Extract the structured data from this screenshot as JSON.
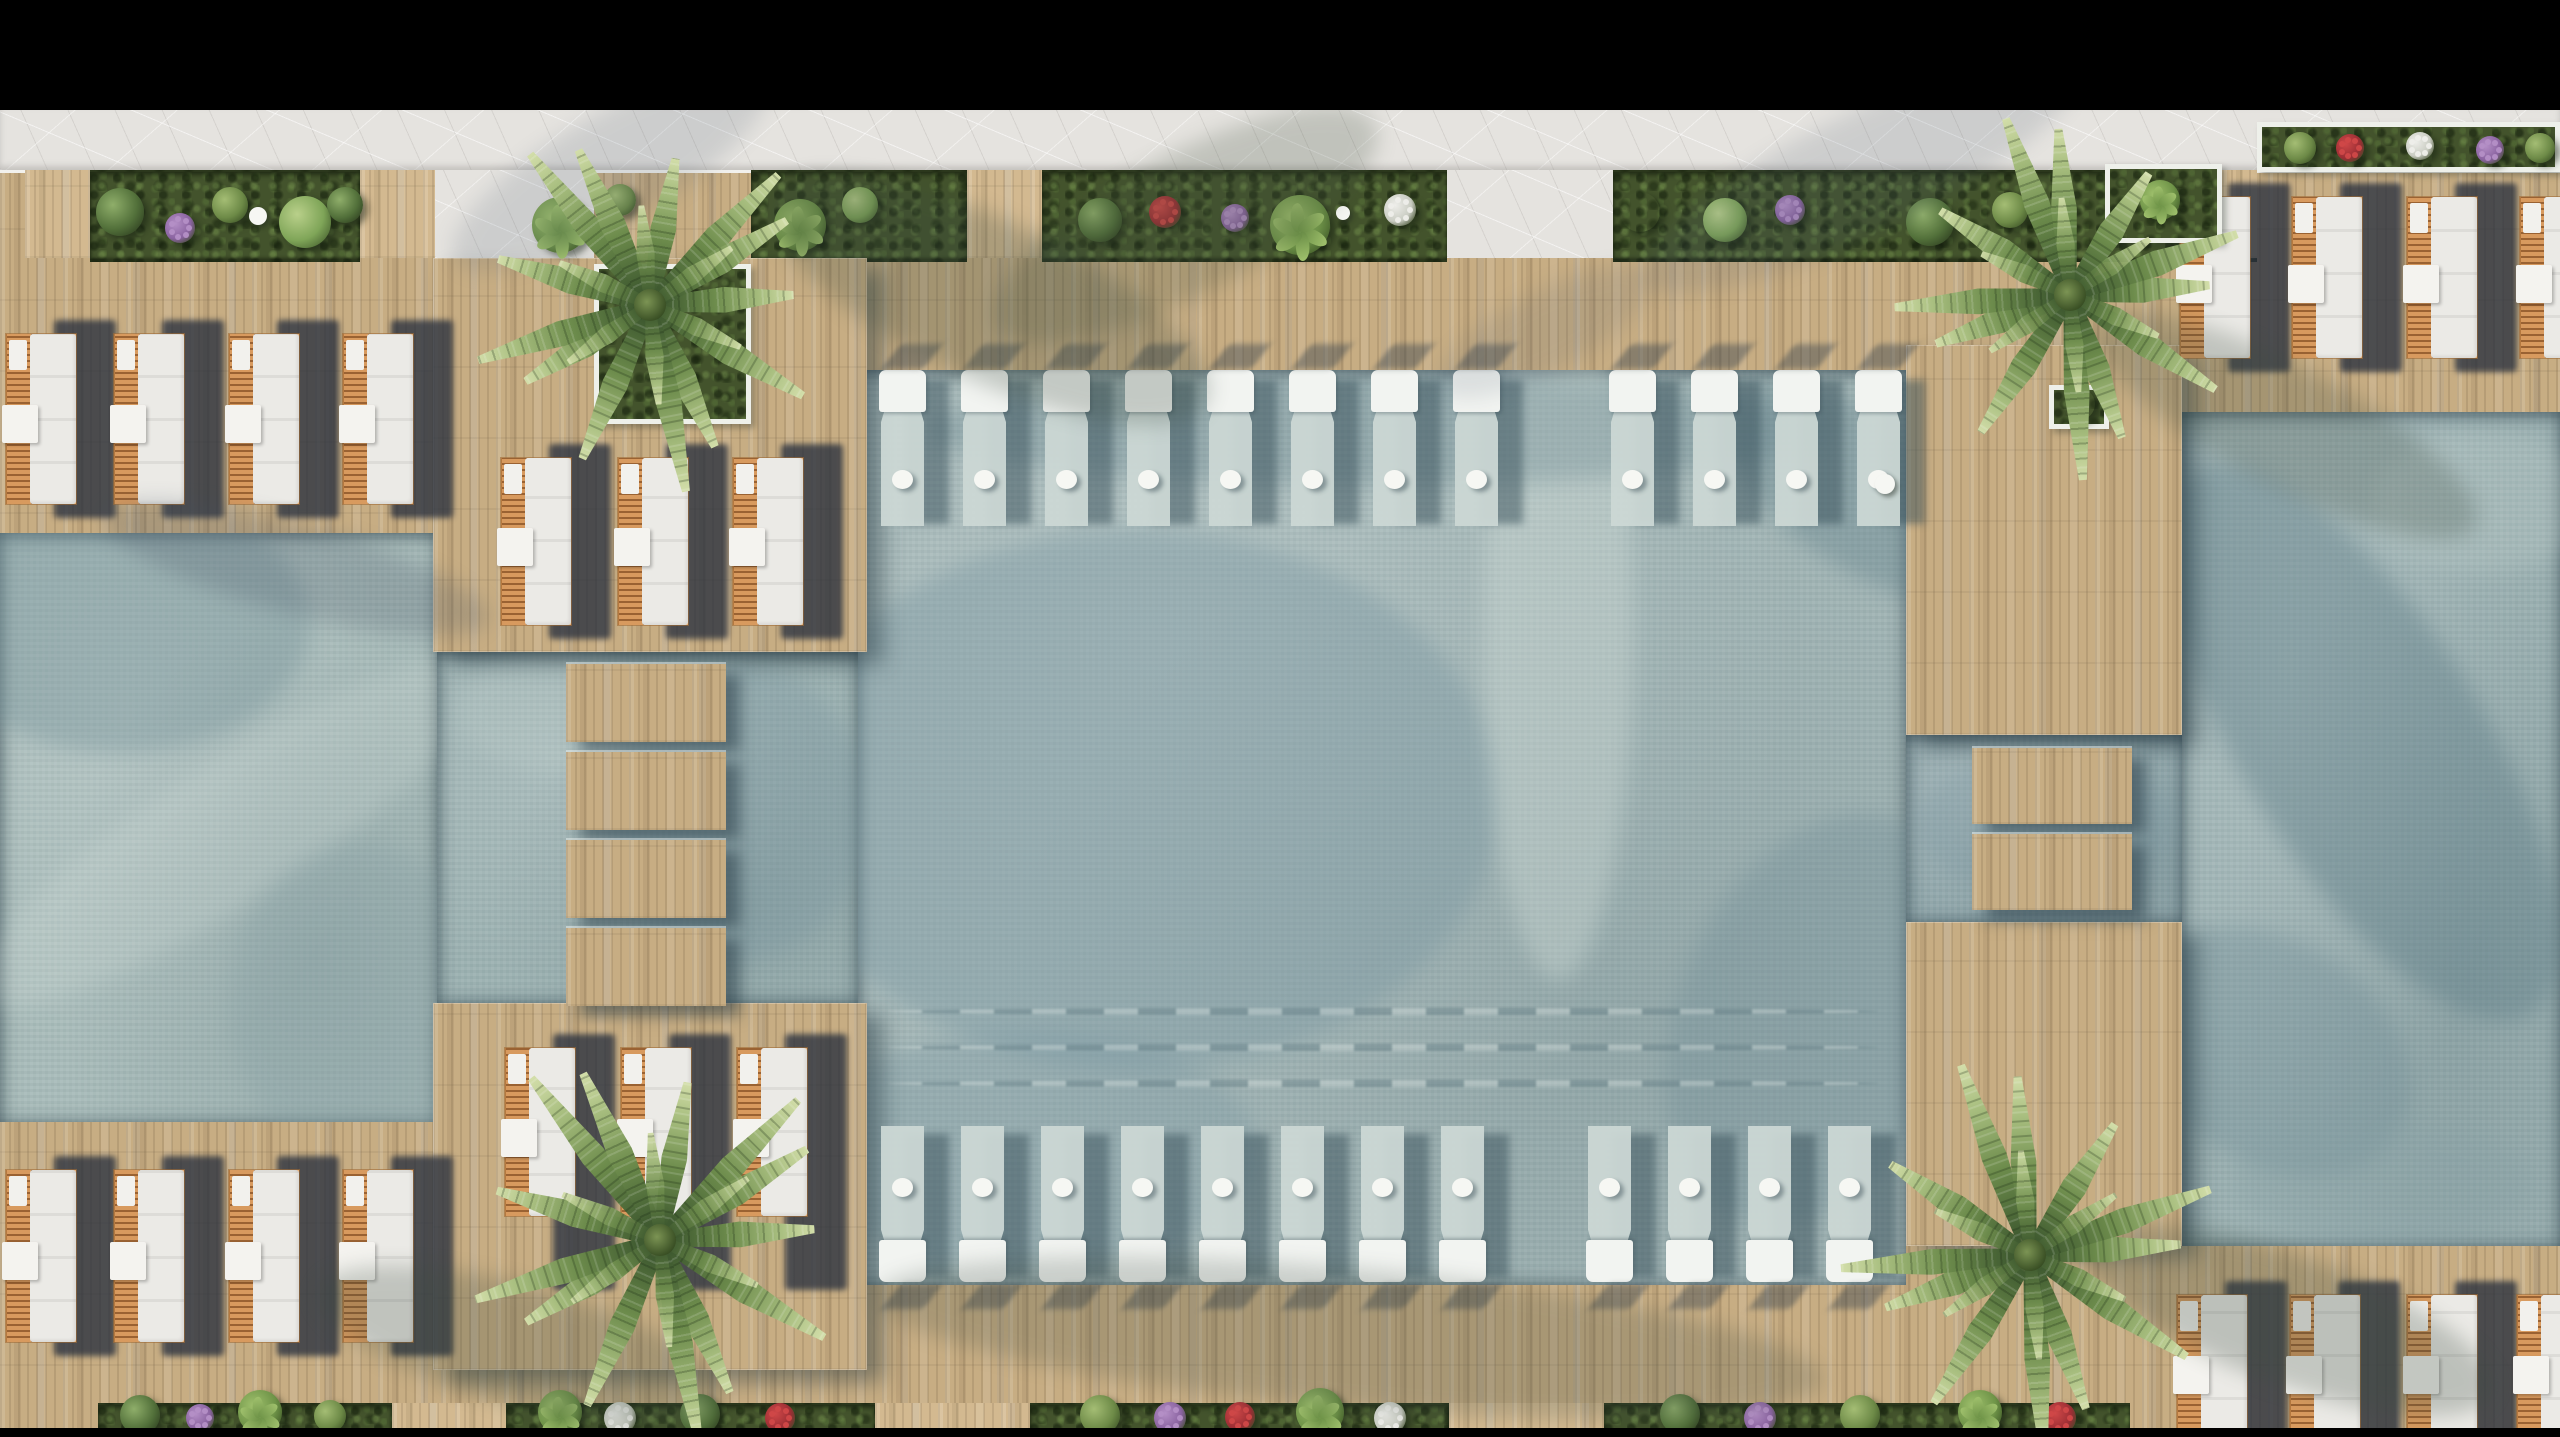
{
  "meta": {
    "description": "Aerial top-down 3D architectural rendering of a resort pool deck: three connected pools with stepping stones, wooden deck, sun loungers, in-pool loungers and palm trees",
    "width": 2560,
    "height": 1437
  },
  "palette": {
    "black": "#000000",
    "pavement": "#e5e3df",
    "deck": "#c7ad83",
    "deck_path": "#d3bd96",
    "garden": "#43532c",
    "garden_dark": "#2c3a1e",
    "water_left": "#a9bcba",
    "water_left_channel": "#9db2b2",
    "water_central": "#a3b6b6",
    "water_right_channel": "#92a8ac",
    "water_right": "#9cb1b2",
    "lounger_cushion": "#ebeae6",
    "lounger_wood": "#cf8f52",
    "pool_lounger_head": "#f2f4f1",
    "pool_lounger_body": "#ccd8d4",
    "shadow_furniture": "rgba(40,48,62,0.78)",
    "white_dot": "#f6f7f3",
    "planter_wall": "#eef0ea"
  },
  "bars": {
    "top": {
      "x": 0,
      "y": 0,
      "w": 2560,
      "h": 110
    },
    "bottom": {
      "x": 0,
      "y": 1428,
      "w": 2560,
      "h": 9
    }
  },
  "pavement_band": {
    "x": 0,
    "y": 110,
    "w": 2560,
    "h": 60
  },
  "garden_strips": {
    "top": {
      "y": 170,
      "h": 88,
      "segments": [
        {
          "type": "deck",
          "x": 25,
          "w": 65
        },
        {
          "type": "garden",
          "x": 90,
          "w": 270
        },
        {
          "type": "path",
          "x": 360,
          "w": 75
        },
        {
          "type": "pave",
          "x": 435,
          "w": 159
        },
        {
          "type": "garden",
          "x": 751,
          "w": 216
        },
        {
          "type": "path",
          "x": 967,
          "w": 75
        },
        {
          "type": "garden",
          "x": 1042,
          "w": 405
        },
        {
          "type": "pave",
          "x": 1447,
          "w": 166
        },
        {
          "type": "garden",
          "x": 1613,
          "w": 644
        },
        {
          "type": "deck",
          "x": 2222,
          "w": 35
        }
      ]
    },
    "bottom": {
      "y": 1403,
      "h": 34,
      "segments": [
        {
          "type": "garden",
          "x": 98,
          "w": 294
        },
        {
          "type": "path",
          "x": 392,
          "w": 114
        },
        {
          "type": "garden",
          "x": 506,
          "w": 369
        },
        {
          "type": "path",
          "x": 875,
          "w": 155
        },
        {
          "type": "garden",
          "x": 1030,
          "w": 419
        },
        {
          "type": "path",
          "x": 1449,
          "w": 155
        },
        {
          "type": "garden",
          "x": 1604,
          "w": 526
        }
      ]
    }
  },
  "pools": [
    {
      "name": "left-pool",
      "x": 0,
      "y": 533,
      "w": 437,
      "h": 589,
      "base": "water_left",
      "patches": [
        {
          "cx": 120,
          "cy": 90,
          "w": 380,
          "h": 260,
          "rot": 0,
          "c": "#6e8c94",
          "a": 0.35
        },
        {
          "cx": 230,
          "cy": 300,
          "w": 600,
          "h": 140,
          "rot": -33,
          "c": "#e8efe9",
          "a": 0.16
        },
        {
          "cx": 360,
          "cy": 470,
          "w": 260,
          "h": 320,
          "rot": 0,
          "c": "#87a0a4",
          "a": 0.28
        }
      ]
    },
    {
      "name": "left-channel",
      "x": 437,
      "y": 652,
      "w": 421,
      "h": 351,
      "base": "water_left_channel",
      "patches": [
        {
          "cx": 300,
          "cy": 160,
          "w": 260,
          "h": 300,
          "rot": 0,
          "c": "#7b96a0",
          "a": 0.35
        },
        {
          "cx": 120,
          "cy": 60,
          "w": 200,
          "h": 120,
          "rot": 0,
          "c": "#c6d4d0",
          "a": 0.2
        }
      ]
    },
    {
      "name": "central-pool",
      "x": 858,
      "y": 370,
      "w": 1048,
      "h": 915,
      "base": "water_central",
      "patches": [
        {
          "cx": 280,
          "cy": 430,
          "w": 720,
          "h": 540,
          "rot": 0,
          "c": "#7a97a1",
          "a": 0.4
        },
        {
          "cx": 700,
          "cy": 260,
          "w": 150,
          "h": 700,
          "rot": 0,
          "c": "#dce6df",
          "a": 0.3
        },
        {
          "cx": 1000,
          "cy": 120,
          "w": 320,
          "h": 150,
          "rot": 35,
          "c": "#5e7d87",
          "a": 0.35
        },
        {
          "cx": 170,
          "cy": 780,
          "w": 460,
          "h": 240,
          "rot": 0,
          "c": "#7a97a1",
          "a": 0.33
        },
        {
          "cx": 960,
          "cy": 650,
          "w": 280,
          "h": 430,
          "rot": 22,
          "c": "#6d8a94",
          "a": 0.3
        },
        {
          "cx": 520,
          "cy": 60,
          "w": 900,
          "h": 110,
          "rot": 0,
          "c": "#5e7d87",
          "a": 0.28
        }
      ]
    },
    {
      "name": "right-channel",
      "x": 1906,
      "y": 735,
      "w": 276,
      "h": 187,
      "base": "water_right_channel",
      "patches": [
        {
          "cx": 140,
          "cy": 90,
          "w": 260,
          "h": 140,
          "rot": 0,
          "c": "#7b96a0",
          "a": 0.3
        }
      ]
    },
    {
      "name": "right-pool",
      "x": 2182,
      "y": 412,
      "w": 378,
      "h": 834,
      "base": "water_right",
      "patches": [
        {
          "cx": 180,
          "cy": 330,
          "w": 640,
          "h": 240,
          "rot": 58,
          "c": "#5d7c86",
          "a": 0.4
        },
        {
          "cx": 300,
          "cy": 90,
          "w": 220,
          "h": 140,
          "rot": 0,
          "c": "#c6d4d0",
          "a": 0.22
        },
        {
          "cx": 90,
          "cy": 640,
          "w": 300,
          "h": 220,
          "rot": 35,
          "c": "#6d8a94",
          "a": 0.33
        },
        {
          "cx": 200,
          "cy": 770,
          "w": 300,
          "h": 120,
          "rot": 0,
          "c": "#87a0a4",
          "a": 0.3
        }
      ]
    }
  ],
  "ripples": {
    "pool": "central-pool",
    "x": 30,
    "w": 990,
    "ys": [
      638,
      674,
      710
    ]
  },
  "platforms": [
    {
      "name": "top-platform",
      "x": 433,
      "y": 258,
      "w": 434,
      "h": 394
    },
    {
      "name": "bottom-platform",
      "x": 433,
      "y": 1003,
      "w": 434,
      "h": 367
    },
    {
      "name": "upper-pier",
      "x": 1906,
      "y": 345,
      "w": 276,
      "h": 390
    },
    {
      "name": "lower-pier",
      "x": 1906,
      "y": 922,
      "w": 276,
      "h": 324
    }
  ],
  "stepping_stones": {
    "left": {
      "x": 566,
      "w": 160,
      "h": 78,
      "ys": [
        664,
        752,
        840,
        928
      ]
    },
    "right": {
      "x": 1972,
      "w": 160,
      "h": 76,
      "ys": [
        748,
        834
      ]
    }
  },
  "pool_lounger_rows": [
    {
      "name": "top-row",
      "y": 370,
      "h": 158,
      "dot_y": 470,
      "flip": false,
      "groups": [
        {
          "x0": 879,
          "n": 8,
          "pitch": 82
        },
        {
          "x0": 1609,
          "n": 4,
          "pitch": 82
        }
      ]
    },
    {
      "name": "bottom-row",
      "y": 1124,
      "h": 158,
      "dot_y": 1178,
      "flip": true,
      "groups": [
        {
          "x0": 879,
          "n": 8,
          "pitch": 80
        },
        {
          "x0": 1586,
          "n": 4,
          "pitch": 80
        }
      ]
    }
  ],
  "deck_lounger_groups": [
    {
      "name": "top-left",
      "y": 334,
      "h": 170,
      "xs": [
        6,
        114,
        229,
        343
      ]
    },
    {
      "name": "top-middle",
      "y": 458,
      "h": 167,
      "xs": [
        501,
        618,
        733
      ]
    },
    {
      "name": "top-right",
      "y": 197,
      "h": 161,
      "xs": [
        2180,
        2292,
        2407,
        2520
      ]
    },
    {
      "name": "bottom-left",
      "y": 1170,
      "h": 172,
      "xs": [
        6,
        114,
        229,
        343
      ]
    },
    {
      "name": "bottom-middle",
      "y": 1048,
      "h": 168,
      "xs": [
        505,
        621,
        737
      ],
      "shadow_extend": 60
    },
    {
      "name": "bottom-right",
      "y": 1295,
      "h": 145,
      "xs": [
        2177,
        2290,
        2407,
        2517
      ]
    }
  ],
  "planters": [
    {
      "name": "palm-planter-top-left",
      "x": 594,
      "y": 264,
      "w": 157,
      "h": 160
    },
    {
      "name": "palm-planter-top-right",
      "x": 2105,
      "y": 164,
      "w": 117,
      "h": 79
    },
    {
      "name": "flower-planter-top-right",
      "x": 2257,
      "y": 122,
      "w": 303,
      "h": 50
    },
    {
      "name": "agave-planter",
      "x": 2049,
      "y": 385,
      "w": 60,
      "h": 44
    }
  ],
  "palms": [
    {
      "name": "palm-top-left",
      "cx": 650,
      "cy": 305,
      "r": 200,
      "fronds": 13
    },
    {
      "name": "palm-top-right",
      "cx": 2070,
      "cy": 295,
      "r": 195,
      "fronds": 12
    },
    {
      "name": "palm-bottom-left",
      "cx": 660,
      "cy": 1240,
      "r": 215,
      "fronds": 13
    },
    {
      "name": "palm-bottom-right",
      "cx": 2030,
      "cy": 1255,
      "r": 210,
      "fronds": 12
    }
  ],
  "plants_top": [
    {
      "x": 120,
      "y": 212,
      "r": 24,
      "type": "shrub"
    },
    {
      "x": 180,
      "y": 228,
      "r": 15,
      "type": "flowers-purple"
    },
    {
      "x": 230,
      "y": 205,
      "r": 18,
      "type": "grass"
    },
    {
      "x": 305,
      "y": 222,
      "r": 26,
      "type": "shrub-light"
    },
    {
      "x": 345,
      "y": 205,
      "r": 18,
      "type": "shrub"
    },
    {
      "x": 560,
      "y": 225,
      "r": 28,
      "type": "banana"
    },
    {
      "x": 620,
      "y": 200,
      "r": 16,
      "type": "grass"
    },
    {
      "x": 800,
      "y": 225,
      "r": 26,
      "type": "banana"
    },
    {
      "x": 860,
      "y": 205,
      "r": 18,
      "type": "shrub-light"
    },
    {
      "x": 1100,
      "y": 220,
      "r": 22,
      "type": "shrub"
    },
    {
      "x": 1165,
      "y": 212,
      "r": 16,
      "type": "flowers-red"
    },
    {
      "x": 1235,
      "y": 218,
      "r": 14,
      "type": "flowers-purple"
    },
    {
      "x": 1300,
      "y": 225,
      "r": 30,
      "type": "banana"
    },
    {
      "x": 1400,
      "y": 210,
      "r": 16,
      "type": "flowers-white"
    },
    {
      "x": 1640,
      "y": 212,
      "r": 20,
      "type": "agave"
    },
    {
      "x": 1725,
      "y": 220,
      "r": 22,
      "type": "shrub-light"
    },
    {
      "x": 1790,
      "y": 210,
      "r": 15,
      "type": "flowers-purple"
    },
    {
      "x": 1930,
      "y": 222,
      "r": 24,
      "type": "shrub"
    },
    {
      "x": 2010,
      "y": 210,
      "r": 18,
      "type": "grass"
    },
    {
      "x": 2160,
      "y": 200,
      "r": 20,
      "type": "banana"
    },
    {
      "x": 2300,
      "y": 148,
      "r": 16,
      "type": "grass"
    },
    {
      "x": 2350,
      "y": 148,
      "r": 14,
      "type": "flowers-red"
    },
    {
      "x": 2420,
      "y": 146,
      "r": 14,
      "type": "flowers-white"
    },
    {
      "x": 2490,
      "y": 150,
      "r": 14,
      "type": "flowers-purple"
    },
    {
      "x": 2540,
      "y": 148,
      "r": 15,
      "type": "grass"
    },
    {
      "x": 2079,
      "y": 404,
      "r": 16,
      "type": "agave"
    }
  ],
  "plants_bottom": [
    {
      "x": 140,
      "y": 1415,
      "r": 20,
      "type": "shrub"
    },
    {
      "x": 200,
      "y": 1418,
      "r": 14,
      "type": "flowers-purple"
    },
    {
      "x": 260,
      "y": 1412,
      "r": 22,
      "type": "banana"
    },
    {
      "x": 330,
      "y": 1416,
      "r": 16,
      "type": "grass"
    },
    {
      "x": 560,
      "y": 1412,
      "r": 22,
      "type": "banana"
    },
    {
      "x": 620,
      "y": 1418,
      "r": 16,
      "type": "flowers-white"
    },
    {
      "x": 700,
      "y": 1414,
      "r": 20,
      "type": "shrub"
    },
    {
      "x": 780,
      "y": 1418,
      "r": 15,
      "type": "flowers-red"
    },
    {
      "x": 1100,
      "y": 1415,
      "r": 20,
      "type": "grass"
    },
    {
      "x": 1170,
      "y": 1418,
      "r": 16,
      "type": "flowers-purple"
    },
    {
      "x": 1240,
      "y": 1417,
      "r": 15,
      "type": "flowers-red"
    },
    {
      "x": 1320,
      "y": 1412,
      "r": 24,
      "type": "banana"
    },
    {
      "x": 1390,
      "y": 1418,
      "r": 16,
      "type": "flowers-white"
    },
    {
      "x": 1680,
      "y": 1414,
      "r": 20,
      "type": "shrub"
    },
    {
      "x": 1760,
      "y": 1418,
      "r": 16,
      "type": "flowers-purple"
    },
    {
      "x": 1860,
      "y": 1415,
      "r": 20,
      "type": "grass"
    },
    {
      "x": 1980,
      "y": 1412,
      "r": 22,
      "type": "banana"
    },
    {
      "x": 2060,
      "y": 1418,
      "r": 16,
      "type": "flowers-red"
    }
  ],
  "white_dots": [
    {
      "name": "garden-table",
      "x": 258,
      "y": 216,
      "r": 9
    },
    {
      "name": "garden-table",
      "x": 1343,
      "y": 213,
      "r": 7
    },
    {
      "name": "pool-float",
      "x": 1885,
      "y": 484,
      "r": 10
    }
  ],
  "scene_shadows": [
    {
      "cx": 610,
      "cy": 170,
      "w": 360,
      "h": 110,
      "rot": -30,
      "c": "#46566a",
      "a": 0.15
    },
    {
      "cx": 1185,
      "cy": 225,
      "w": 430,
      "h": 140,
      "rot": -28,
      "c": "#41503f",
      "a": 0.22
    },
    {
      "cx": 1860,
      "cy": 175,
      "w": 480,
      "h": 120,
      "rot": -26,
      "c": "#46566a",
      "a": 0.15
    },
    {
      "cx": 990,
      "cy": 300,
      "w": 480,
      "h": 160,
      "rot": 25,
      "c": "#3b4b40",
      "a": 0.25
    },
    {
      "cx": 295,
      "cy": 568,
      "w": 400,
      "h": 90,
      "rot": 15,
      "c": "#425060",
      "a": 0.22
    },
    {
      "cx": 2285,
      "cy": 425,
      "w": 430,
      "h": 120,
      "rot": 28,
      "c": "#3b4b40",
      "a": 0.24
    },
    {
      "cx": 1350,
      "cy": 1338,
      "w": 950,
      "h": 140,
      "rot": 5,
      "c": "#3e4c44",
      "a": 0.22
    },
    {
      "cx": 2290,
      "cy": 1320,
      "w": 430,
      "h": 130,
      "rot": 20,
      "c": "#3b4b40",
      "a": 0.26
    },
    {
      "cx": 520,
      "cy": 1345,
      "w": 420,
      "h": 120,
      "rot": 15,
      "c": "#3b4b40",
      "a": 0.24
    },
    {
      "cx": 1545,
      "cy": 332,
      "w": 240,
      "h": 80,
      "rot": -28,
      "c": "#46566a",
      "a": 0.13
    }
  ]
}
